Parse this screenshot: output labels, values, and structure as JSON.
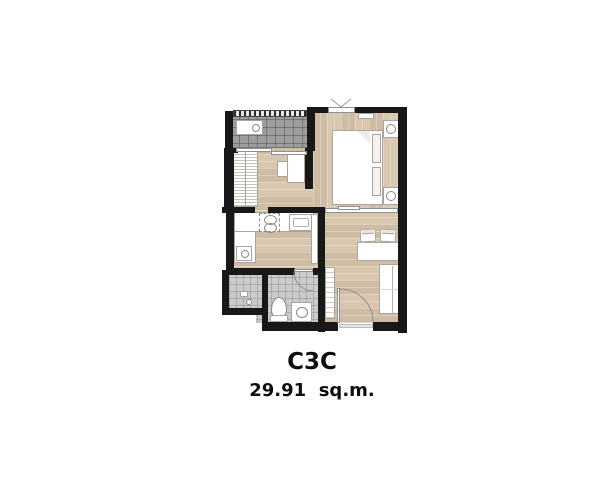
{
  "plan": {
    "unit_name": "C3C",
    "unit_area": "29.91  sq.m."
  },
  "colors": {
    "background": "#ffffff",
    "wall": "#181818",
    "wood_floor": "#d8c6ae",
    "balcony_tile": "#9d9d9d",
    "bathroom_tile": "#cbcbcb",
    "fixture_outline": "#a9a49c",
    "label_text": "#0d0d0d"
  },
  "rooms": [
    {
      "name": "balcony"
    },
    {
      "name": "bedroom"
    },
    {
      "name": "dressing-study-hall"
    },
    {
      "name": "kitchen"
    },
    {
      "name": "bathroom"
    },
    {
      "name": "living-dining"
    }
  ],
  "furniture": [
    {
      "room": "balcony",
      "item": "ac-condenser-unit"
    },
    {
      "room": "bedroom",
      "item": "double-bed"
    },
    {
      "room": "bedroom",
      "item": "nightstand-with-lamp"
    },
    {
      "room": "bedroom",
      "item": "nightstand-with-lamp"
    },
    {
      "room": "bedroom",
      "item": "window"
    },
    {
      "room": "dressing-study-hall",
      "item": "wardrobe"
    },
    {
      "room": "dressing-study-hall",
      "item": "desk-and-chair"
    },
    {
      "room": "kitchen",
      "item": "counter-l-shape"
    },
    {
      "room": "kitchen",
      "item": "two-burner-stove"
    },
    {
      "room": "kitchen",
      "item": "sink"
    },
    {
      "room": "kitchen",
      "item": "washing-machine"
    },
    {
      "room": "bathroom",
      "item": "shower"
    },
    {
      "room": "bathroom",
      "item": "toilet"
    },
    {
      "room": "bathroom",
      "item": "vanity-basin"
    },
    {
      "room": "living-dining",
      "item": "dining-table-two-chairs"
    },
    {
      "room": "living-dining",
      "item": "sofa"
    },
    {
      "room": "living-dining",
      "item": "tv-console"
    },
    {
      "room": "living-dining",
      "item": "entrance-door"
    }
  ]
}
